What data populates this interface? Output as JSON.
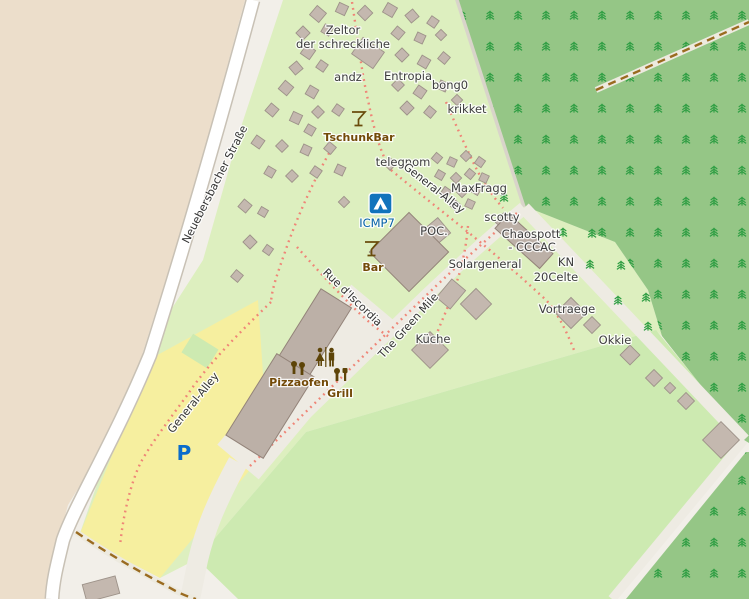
{
  "map": {
    "palette": {
      "background": "#f2efe9",
      "camp_green": "#ddefbf",
      "grass_green": "#cdeab1",
      "forest_green": "#95c686",
      "tree_glyph_green": "#2f9e43",
      "sand_yellow": "#f6ef9f",
      "farmland_tan": "#ecdecb",
      "road_white": "#ffffff",
      "road_grey": "#eeebe3",
      "building_grey": "#c4b8af",
      "footpath_red": "#ef8577",
      "track_brown": "#9a6b20",
      "poi_brown": "#734a08",
      "poi_blue": "#0561a8",
      "parking_blue": "#0a6ccc"
    },
    "labels": {
      "zeltor_line1": "Zeltor",
      "zeltor_line2": "der schreckliche",
      "andz": "andz",
      "entropia": "Entropia",
      "bong0": "bong0",
      "krikket": "krikket",
      "tschunkbar": "TschunkBar",
      "telegnom": "telegnom",
      "general_alley_upper": "General-Alley",
      "maxfragg": "MaxFragg",
      "scotty": "scotty",
      "icmp7": "ICMP7",
      "poc": "POC.",
      "chaospott_line1": "Chaospott",
      "chaospott_line2": "- CCCAC",
      "bar": "Bar",
      "solargeneral": "Solargeneral",
      "kn": "KN",
      "celte20": "20Celte",
      "rue_discordia": "Rue d'Iscordia",
      "green_mile": "The Green Mile",
      "kueche": "Küche",
      "vortraege": "Vortraege",
      "okkie": "Okkie",
      "pizzaofen": "Pizzaofen",
      "grill": "Grill",
      "strasse": "Neuebersbacher Straße",
      "general_alley_lower": "General-Alley",
      "parking": "P"
    },
    "icons": {
      "campsite": "campsite-icon",
      "tschunkbar": "cocktail-icon",
      "bar": "cocktail-icon",
      "toilets": "toilets-icon",
      "pizzaofen": "pizza-oven-icon",
      "grill": "grill-icon",
      "parking": "parking-icon"
    },
    "tents": [
      [
        318,
        14,
        12,
        40
      ],
      [
        342,
        9,
        10,
        25
      ],
      [
        365,
        13,
        11,
        45
      ],
      [
        390,
        10,
        11,
        30
      ],
      [
        412,
        16,
        10,
        50
      ],
      [
        433,
        22,
        9,
        35
      ],
      [
        303,
        33,
        10,
        45
      ],
      [
        327,
        30,
        9,
        30
      ],
      [
        398,
        33,
        10,
        40
      ],
      [
        420,
        38,
        9,
        25
      ],
      [
        441,
        35,
        8,
        45
      ],
      [
        308,
        52,
        11,
        35
      ],
      [
        402,
        55,
        10,
        45
      ],
      [
        424,
        62,
        10,
        30
      ],
      [
        444,
        58,
        9,
        40
      ],
      [
        296,
        68,
        10,
        50
      ],
      [
        322,
        66,
        9,
        35
      ],
      [
        286,
        88,
        11,
        40
      ],
      [
        312,
        92,
        10,
        30
      ],
      [
        398,
        85,
        9,
        45
      ],
      [
        420,
        92,
        10,
        35
      ],
      [
        443,
        86,
        9,
        25
      ],
      [
        457,
        100,
        8,
        45
      ],
      [
        272,
        110,
        10,
        40
      ],
      [
        296,
        118,
        10,
        25
      ],
      [
        318,
        112,
        9,
        45
      ],
      [
        338,
        110,
        9,
        35
      ],
      [
        310,
        130,
        9,
        30
      ],
      [
        407,
        108,
        10,
        45
      ],
      [
        430,
        112,
        9,
        40
      ],
      [
        258,
        142,
        10,
        35
      ],
      [
        282,
        146,
        9,
        45
      ],
      [
        306,
        150,
        9,
        25
      ],
      [
        330,
        148,
        9,
        40
      ],
      [
        390,
        164,
        9,
        45
      ],
      [
        270,
        172,
        9,
        30
      ],
      [
        292,
        176,
        9,
        45
      ],
      [
        316,
        172,
        9,
        35
      ],
      [
        340,
        170,
        9,
        25
      ],
      [
        245,
        206,
        10,
        40
      ],
      [
        263,
        212,
        8,
        30
      ],
      [
        250,
        242,
        10,
        45
      ],
      [
        268,
        250,
        8,
        35
      ],
      [
        237,
        276,
        9,
        40
      ],
      [
        344,
        202,
        8,
        45
      ],
      [
        437,
        158,
        8,
        40
      ],
      [
        452,
        162,
        8,
        25
      ],
      [
        466,
        156,
        8,
        45
      ],
      [
        480,
        162,
        8,
        35
      ],
      [
        440,
        175,
        8,
        30
      ],
      [
        456,
        178,
        8,
        45
      ],
      [
        470,
        174,
        8,
        40
      ],
      [
        484,
        178,
        8,
        25
      ],
      [
        446,
        192,
        8,
        35
      ],
      [
        462,
        192,
        8,
        45
      ],
      [
        476,
        190,
        8,
        30
      ],
      [
        455,
        205,
        8,
        40
      ],
      [
        470,
        204,
        8,
        25
      ]
    ],
    "buildings": [
      [
        368,
        53,
        26,
        20,
        35
      ],
      [
        435,
        233,
        24,
        20,
        -40
      ],
      [
        505,
        222,
        14,
        13,
        40
      ],
      [
        451,
        294,
        18,
        24,
        40
      ],
      [
        476,
        304,
        22,
        22,
        45
      ],
      [
        430,
        350,
        26,
        26,
        45
      ],
      [
        571,
        313,
        22,
        22,
        45
      ],
      [
        592,
        325,
        12,
        12,
        45
      ],
      [
        630,
        355,
        14,
        14,
        45
      ],
      [
        654,
        378,
        12,
        12,
        45
      ],
      [
        670,
        388,
        8,
        8,
        45
      ],
      [
        686,
        401,
        12,
        12,
        45
      ],
      [
        721,
        440,
        26,
        26,
        45
      ],
      [
        101,
        589,
        34,
        18,
        -15
      ]
    ],
    "trees": [
      [
        563,
        232
      ],
      [
        592,
        233
      ],
      [
        504,
        197
      ],
      [
        590,
        264
      ],
      [
        621,
        265
      ],
      [
        618,
        300
      ],
      [
        646,
        297
      ],
      [
        648,
        326
      ]
    ]
  }
}
